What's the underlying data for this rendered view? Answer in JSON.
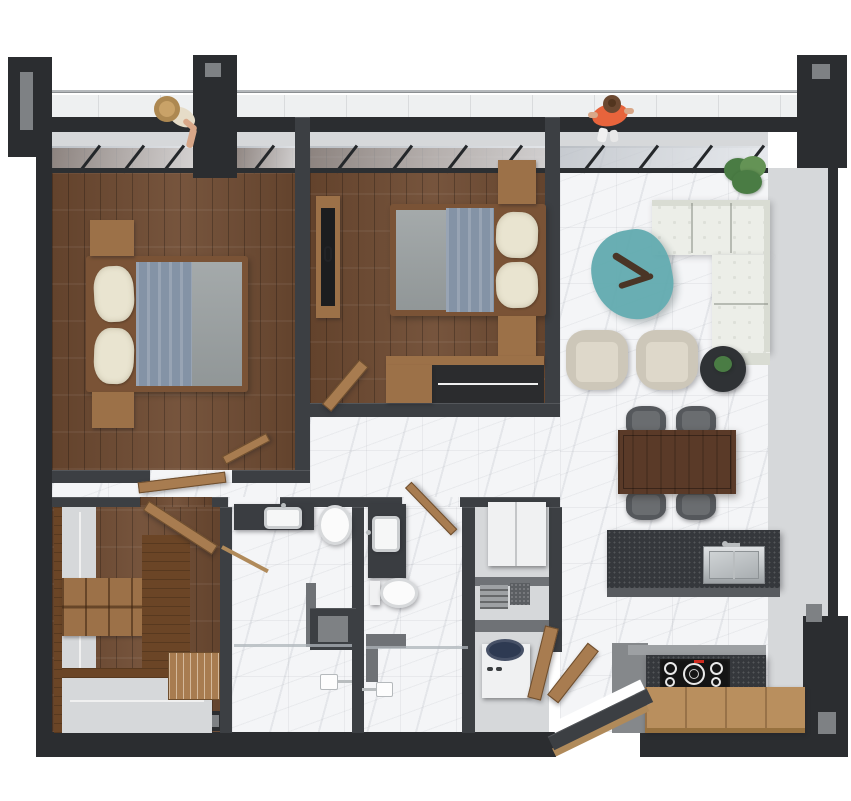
{
  "scene": {
    "description": "Top-down 3D architectural render of a two-bedroom apartment floor plan with balcony, living-dining-kitchen area, two bathrooms, walk-in closet and utility closet",
    "background_color": "#ffffff"
  },
  "palette": {
    "wall_exterior": "#2b2d30",
    "wall_interior": "#3c3f43",
    "wall_top_highlight": "#54575b",
    "wall_stub_gray": "#6f7276",
    "wall_face_light": "#d6d8da",
    "notch_gray": "#7e8184",
    "balcony_gray": "#eef0f1",
    "rail_gray": "#b4b8bb",
    "wood_floor": "#6e4a31",
    "wood_furniture": "#9c7148",
    "wood_dark": "#6b4526",
    "wood_door": "#a87c50",
    "wood_threshold": "#b08a5a",
    "wood_counter": "#b98f5e",
    "marble_base": "#f4f5f7",
    "bedframe": "#7a5336",
    "mattress_gray": "#9aa0a1",
    "blanket_blue": "#8493a6",
    "pillow_cream": "#e9e4d0",
    "sofa_white": "#eceee8",
    "sofa_edge": "#d9dcd3",
    "armchair_beige": "#cdc7b9",
    "armchair_seat": "#ded8ca",
    "coffee_table_teal": "#5ea9ae",
    "driftwood": "#4a3526",
    "dining_table": "#5a3a28",
    "chair_dark": "#55585c",
    "chair_seat": "#6a6d70",
    "island_dark": "#35383c",
    "counter_dark": "#3a3d41",
    "counter_gray": "#9da0a3",
    "steel": "#c6cacc",
    "appliance_white": "#f0f1f2",
    "washer_lid_navy": "#2e3a52",
    "cooktop_black": "#141414",
    "burner_ring": "#e8e8e8",
    "display_red": "#cf2b20",
    "plant_green": "#4a7c44",
    "plant_green_light": "#649355",
    "pot_dark": "#2f3235",
    "toilet_white": "#fbfbfb",
    "sink_white": "#f6f7f7",
    "shower_glass": "#aeb4b9",
    "rod_white": "#f0f0f0",
    "dark_interior": "#2b2c2e",
    "grille_gray": "#9ea1a4",
    "filter_dark": "#5b5e62",
    "person_shirt_orange": "#e8643c",
    "person_skin": "#d9a788",
    "person_hair": "#6b4831",
    "hat_straw": "#c9a268"
  },
  "rooms": [
    {
      "name": "balcony",
      "contents": [
        "glass railing",
        "person with straw hat",
        "person in orange shirt"
      ]
    },
    {
      "name": "bedroom-1",
      "floor": "dark wood planks",
      "contents": [
        "double bed with blue throw and cream pillows",
        "two wood nightstands",
        "swing door"
      ]
    },
    {
      "name": "bedroom-2",
      "floor": "dark wood planks",
      "contents": [
        "double bed with blue throw and cream pillows",
        "two wood nightstands",
        "wall tv console",
        "open wardrobe with hanging rail",
        "wood bench",
        "swing door"
      ]
    },
    {
      "name": "living-dining-kitchen",
      "floor": "white marble tile",
      "contents": [
        "white l-shaped tufted sofa",
        "teal organic coffee table with driftwood decor",
        "two beige armchairs",
        "round black side table with plant",
        "potted plant",
        "walnut dining table",
        "four dark dining chairs",
        "kitchen island with stainless sink",
        "dark backsplash with induction cooktop",
        "oak worktop"
      ]
    },
    {
      "name": "walk-in-closet",
      "floor": "dark wood planks",
      "contents": [
        "wardrobe shelving",
        "hanging rails",
        "cubby shelves",
        "drawer organizer",
        "tall wood cabinet",
        "swing door"
      ]
    },
    {
      "name": "bathroom-1",
      "floor": "white marble tile",
      "contents": [
        "vanity sink",
        "wall-hung toilet",
        "walk-in shower",
        "storage niche",
        "towel rail"
      ]
    },
    {
      "name": "bathroom-2",
      "floor": "white marble tile",
      "contents": [
        "vanity sink",
        "wall-hung toilet",
        "walk-in shower"
      ]
    },
    {
      "name": "utility-closet",
      "contents": [
        "refrigerator",
        "ventilation unit",
        "top-load washing machine",
        "open double wood doors"
      ]
    },
    {
      "name": "entry",
      "contents": [
        "angled entry wall",
        "wood threshold",
        "open wood door leaf"
      ]
    }
  ]
}
